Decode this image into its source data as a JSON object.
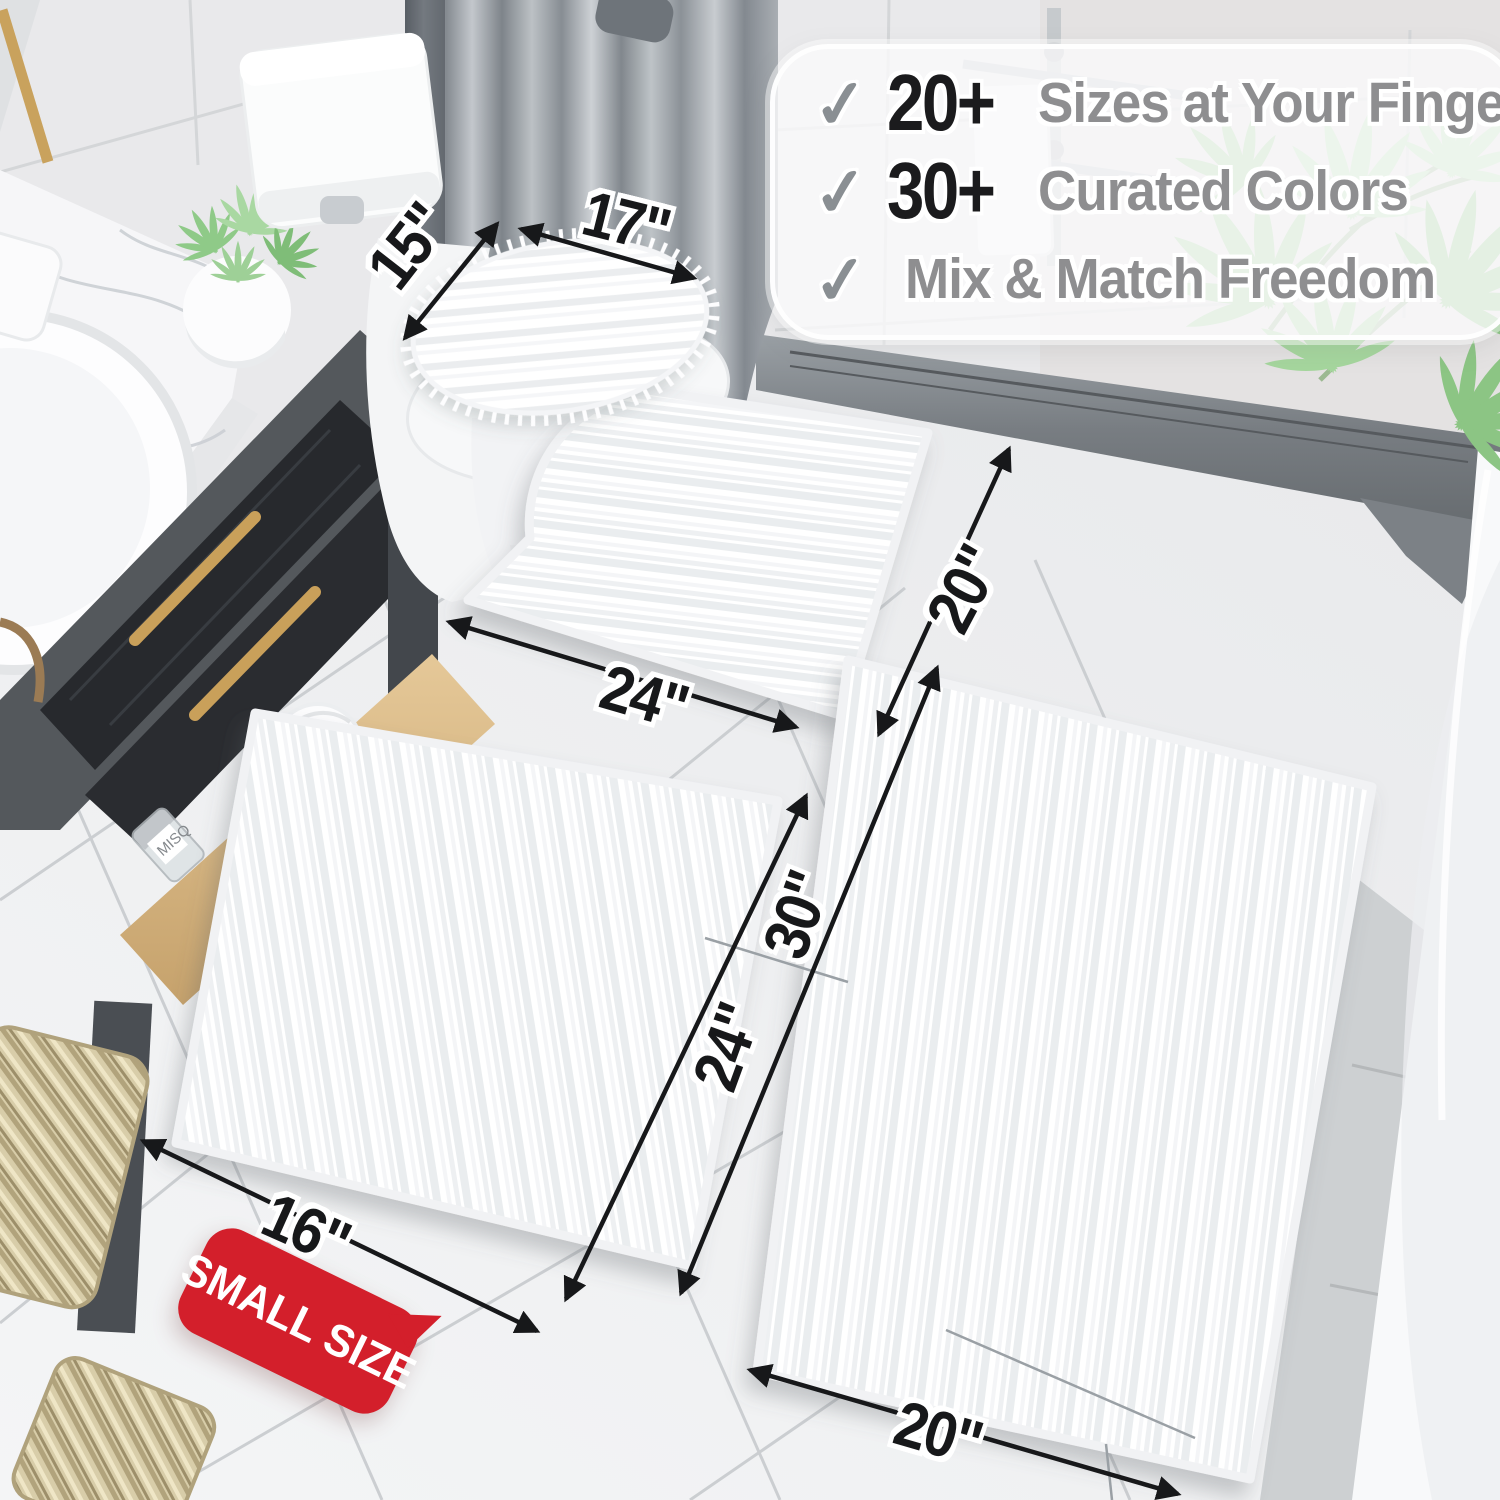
{
  "banner": {
    "check_glyph": "✓",
    "rows": [
      {
        "icon": "check-icon",
        "number": "20+",
        "label": "Sizes at Your Fingertips"
      },
      {
        "icon": "check-icon",
        "number": "30+",
        "label": "Curated Colors"
      },
      {
        "icon": "check-icon",
        "number": "",
        "label": "Mix & Match Freedom"
      }
    ]
  },
  "dimension_labels": {
    "lid_cover_width": "15\"",
    "lid_cover_length": "17\"",
    "contour_mat_width": "24\"",
    "contour_mat_depth": "20\"",
    "small_rug_length": "24\"",
    "large_rug_length": "30\"",
    "small_rug_width": "16\"",
    "large_rug_width": "20\""
  },
  "badge": {
    "label": "SMALL SIZE"
  },
  "misc": {
    "bottle_label": "MISQ"
  },
  "colors": {
    "badge_red": "#d31f2b",
    "dimension_black": "#17181a",
    "banner_text_gray": "#8e8e90",
    "plant_green": "#9ed097",
    "brass_gold": "#c9a05a"
  }
}
